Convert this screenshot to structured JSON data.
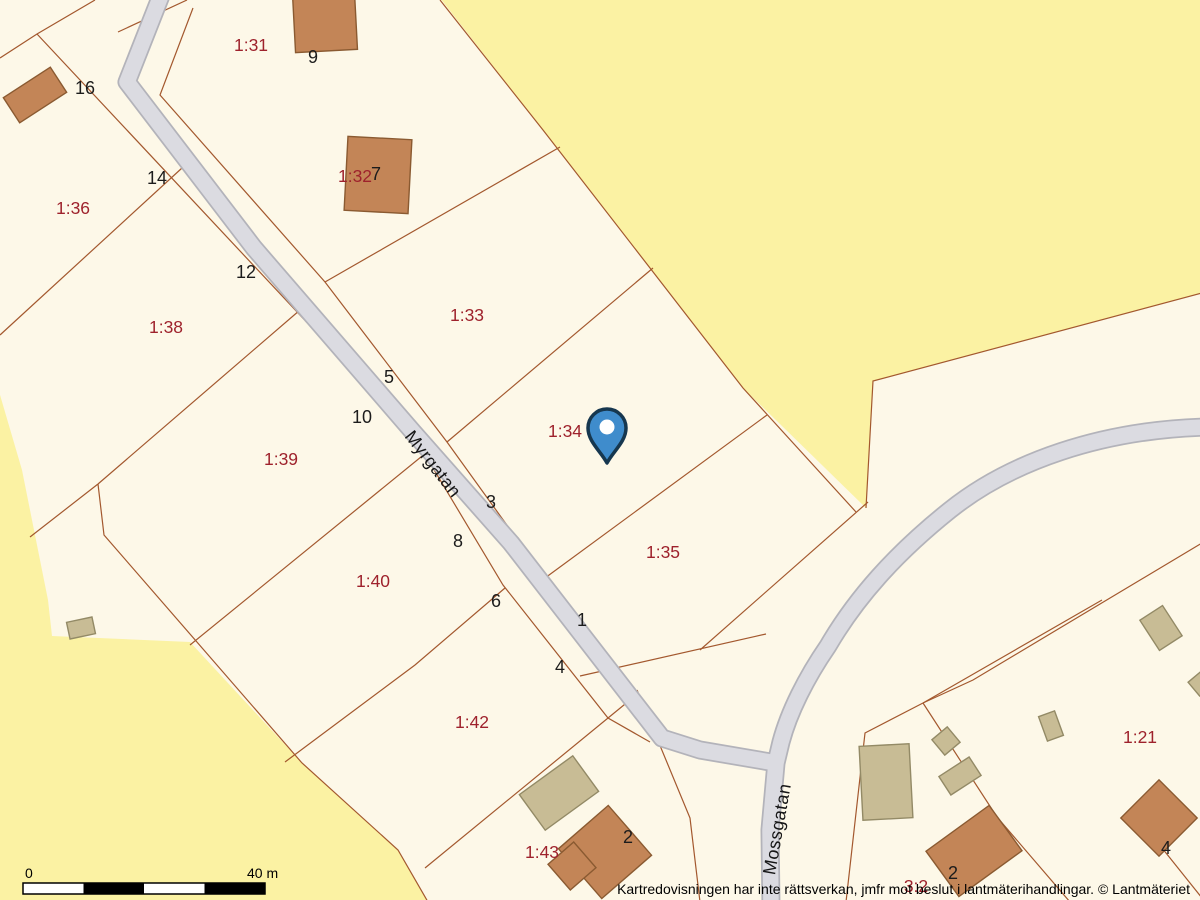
{
  "map": {
    "attribution": "Kartredovisningen har inte rättsverkan, jmfr mot beslut i lantmäterihandlingar. © Lantmäteriet",
    "scale_bar": {
      "start_label": "0",
      "end_label": "40 m"
    },
    "streets": [
      {
        "name": "Myrgatan",
        "x": 433,
        "y": 464,
        "rotation": 52
      },
      {
        "name": "Mossgatan",
        "x": 777,
        "y": 829,
        "rotation": -80
      }
    ],
    "parcel_labels": [
      {
        "text": "1:31",
        "x": 251,
        "y": 45
      },
      {
        "text": "1:32",
        "x": 355,
        "y": 176
      },
      {
        "text": "1:36",
        "x": 73,
        "y": 208
      },
      {
        "text": "1:33",
        "x": 467,
        "y": 315
      },
      {
        "text": "1:38",
        "x": 166,
        "y": 327
      },
      {
        "text": "1:34",
        "x": 565,
        "y": 431
      },
      {
        "text": "1:39",
        "x": 281,
        "y": 459
      },
      {
        "text": "1:35",
        "x": 663,
        "y": 552
      },
      {
        "text": "1:40",
        "x": 373,
        "y": 581
      },
      {
        "text": "1:42",
        "x": 472,
        "y": 722
      },
      {
        "text": "1:21",
        "x": 1140,
        "y": 737
      },
      {
        "text": "1:43",
        "x": 542,
        "y": 852
      },
      {
        "text": "3:2",
        "x": 916,
        "y": 886
      }
    ],
    "house_numbers": [
      {
        "text": "16",
        "x": 85,
        "y": 88
      },
      {
        "text": "9",
        "x": 313,
        "y": 57
      },
      {
        "text": "7",
        "x": 376,
        "y": 174
      },
      {
        "text": "14",
        "x": 157,
        "y": 178
      },
      {
        "text": "12",
        "x": 246,
        "y": 272
      },
      {
        "text": "5",
        "x": 389,
        "y": 377
      },
      {
        "text": "10",
        "x": 362,
        "y": 417
      },
      {
        "text": "3",
        "x": 491,
        "y": 502
      },
      {
        "text": "8",
        "x": 458,
        "y": 541
      },
      {
        "text": "6",
        "x": 496,
        "y": 601
      },
      {
        "text": "1",
        "x": 582,
        "y": 620
      },
      {
        "text": "4",
        "x": 560,
        "y": 667
      },
      {
        "text": "2",
        "x": 628,
        "y": 837
      },
      {
        "text": "2",
        "x": 953,
        "y": 873
      },
      {
        "text": "4",
        "x": 1166,
        "y": 848
      }
    ],
    "marker": {
      "x": 607,
      "y": 428
    },
    "colors": {
      "yellow": "#fbf2a3",
      "cream": "#fdf8e8",
      "lot": "#a3582e",
      "road-fill": "#dbdbe1",
      "road-case": "#b3b3ba",
      "red": "#9e222c",
      "black": "#1c1c1c",
      "bld-brown": "#c38557",
      "bld-brown-line": "#8a5a31",
      "bld-tan": "#c8bc95",
      "bld-tan-line": "#938a66",
      "pin-fill": "#3f8ccc",
      "pin-line": "#16374f"
    }
  }
}
